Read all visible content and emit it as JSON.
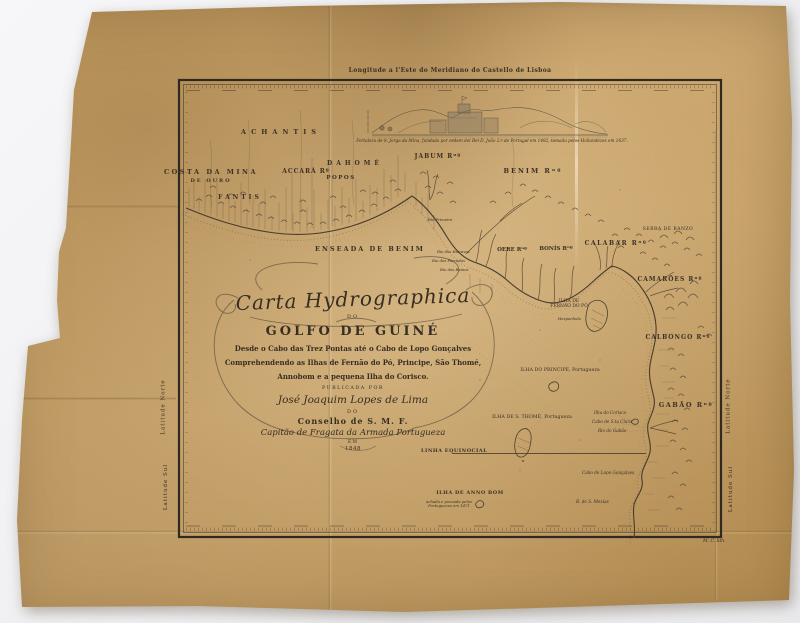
{
  "map": {
    "margins": {
      "top_longitude_label": "Longitude a l'Este do Meridiano do Castello de Lisboa",
      "latitude_north": "Latitude Norte",
      "latitude_south": "Latitude Sul",
      "lith_credit": "M. C. lith."
    },
    "view_caption": "Fortaleza de S. Jorge da Mina, fundada por ordem del Rei D. João 2.º de Portugal em 1482, tomada pelos Hollandezes em 1637.",
    "cartouche": {
      "script_title": "Carta Hydrographica",
      "do_1": "DO",
      "main_title": "GOLFO DE GUINÉ",
      "subtitle_1": "Desde o Cabo das Trez Pontas até o Cabo de Lopo Gonçalves",
      "subtitle_2": "Comprehendendo as Ilhas de Fernão do Pó, Principe, São Thomé,",
      "subtitle_3": "Annobom e a pequena Ilha do Corisco.",
      "published_by": "PUBLICADA POR",
      "author": "José Joaquim Lopes de Lima",
      "do_2": "DO",
      "council": "Conselho de S. M. F.",
      "rank": "Capitão de Fragata da Armada Portugueza",
      "em": "EM",
      "year": "1848"
    },
    "equator_label": "LINHA EQUINOCIAL",
    "regions": {
      "costa_da_mina": "COSTA DA MINA",
      "de_ouro": "DE OURO",
      "achantis": "ACHANTIS",
      "fantis": "FANTIS",
      "accara": "ACCARÁ Rº",
      "popos": "POPOS",
      "dahome": "DAHOMÉ",
      "jabum": "JABUM Rⁿº",
      "benim": "BENIM Rⁿº",
      "enseada_benim": "ENSEADA DE BENIM",
      "oere": "OERE Rⁿº",
      "bonis": "BONÍS Rⁿº",
      "calabar": "CALABAR Rⁿº",
      "camaroes": "CAMARÕES Rⁿº",
      "serra": "SERRA DE BANZO",
      "calbongo": "CALBONGO Rⁿº",
      "gabao": "GABÃO Rⁿº"
    },
    "islands": {
      "fernao_do_po": "ILHA DE FERNÃO DO PÓ",
      "fernao_note": "Hespanhola",
      "principe": "ILHA DO PRINCIPE, Portugueza",
      "sao_thome": "ILHA DE S. THOMÉ, Portugueza",
      "anno_bom": "ILHA DE ANNO BOM",
      "anno_bom_note": "achada e povoada pelos Portuguezes em 1471",
      "corisco": "Ilha do Corisco",
      "cabo_sta_clara": "Cabo de S.ta Clara",
      "rio_do_gabao": "Rio do Gabão",
      "cabo_lopo": "Cabo de Lopo Gonçalves"
    },
    "coast_features": {
      "rio_primeiro": "Rio Primeiro",
      "rio_escravos": "Rio dos Escravos",
      "rio_forcados": "Rio dos Forcados",
      "rio_ramos": "Rio dos Ramos",
      "baia_mexias": "B. de S. Mexias"
    },
    "colors": {
      "paper": "#c9a468",
      "ink": "#3a3126",
      "frame": "#2e2921",
      "background": "#f3f3f5"
    }
  }
}
